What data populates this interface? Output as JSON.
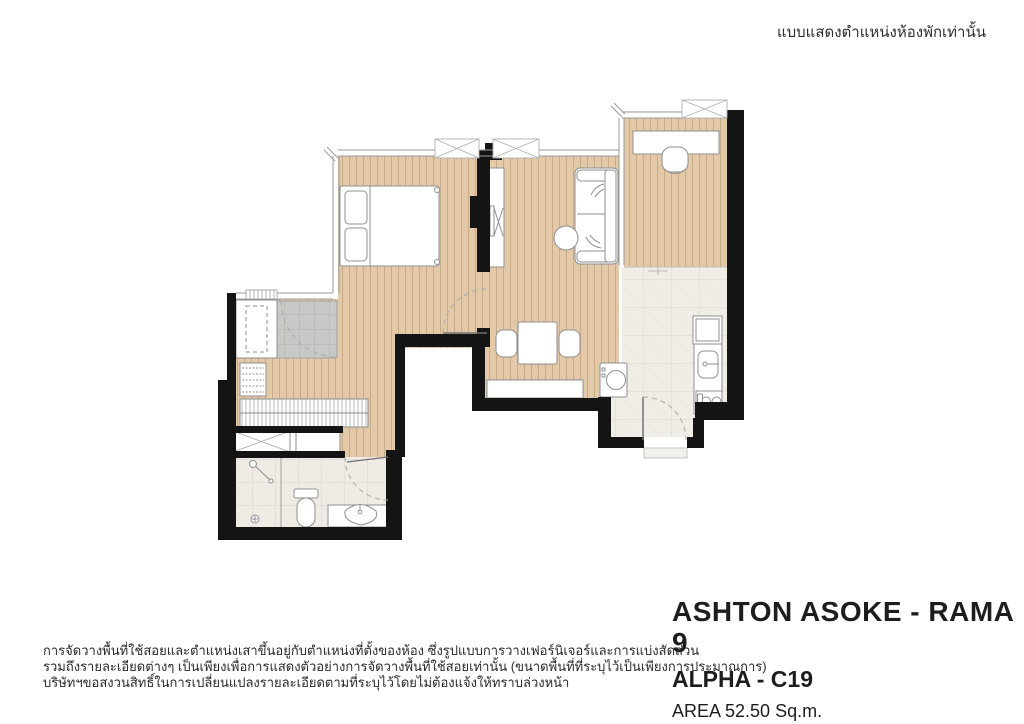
{
  "note": {
    "text": "แบบแสดงตำแหน่งห้องพักเท่านั้น"
  },
  "title_block": {
    "project": "ASHTON ASOKE - RAMA 9",
    "unit": "ALPHA - C19",
    "area": "AREA 52.50 Sq.m."
  },
  "disclaimer": {
    "line1": "การจัดวางพื้นที่ใช้สอยและตำแหน่งเสาขึ้นอยู่กับตำแหน่งที่ตั้งของห้อง ซึ่งรูปแบบการวางเฟอร์นิเจอร์และการแบ่งสัดส่วน",
    "line2": "รวมถึงรายละเอียดต่างๆ เป็นเพียงเพื่อการแสดงตัวอย่างการจัดวางพื้นที่ใช้สอยเท่านั้น (ขนาดพื้นที่ที่ระบุไว้เป็นเพียงการประมาณการ)",
    "line3": "บริษัทฯขอสงวนสิทธิ์ในการเปลี่ยนแปลงรายละเอียดตามที่ระบุไว้โดยไม่ต้องแจ้งให้ทราบล่วงหน้า"
  },
  "palette": {
    "wall": "#141414",
    "wood_floor": "#e3c9a7",
    "wood_stripe": "#b2936f",
    "kitchen_tile": "#f0ede6",
    "bath_tile": "#efece5",
    "tile_grout": "#dbd7cf",
    "gray_tile": "#c8c8c6",
    "furniture_outline": "#8f8f8f",
    "door_arc": "#a9a9a9",
    "text": "#1d1d1b"
  }
}
